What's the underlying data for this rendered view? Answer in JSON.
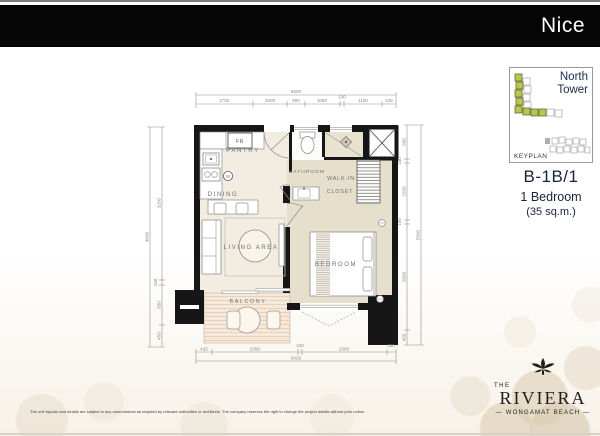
{
  "banner": {
    "title": "Nice"
  },
  "keyplan": {
    "tower": "North Tower",
    "caption": "KEYPLAN"
  },
  "unit": {
    "code": "B-1B/1",
    "type": "1 Bedroom",
    "area": "(35 sq.m.)"
  },
  "rooms": {
    "pantry": "PANTRY",
    "dining": "DINING",
    "living": "LIVING AREA",
    "bathroom": "BATHROOM",
    "walkin_line1": "WALK-IN",
    "walkin_line2": "CLOSET",
    "bedroom": "BEDROOM",
    "balcony": "BALCONY",
    "fridge": "FR",
    "washer": "W"
  },
  "dims": {
    "top_total": "5600",
    "top": [
      "1725",
      "1000",
      "550",
      "1060",
      "100",
      "1150",
      "425"
    ],
    "left_total": "4600",
    "left": [
      "3200",
      "100",
      "850",
      "450"
    ],
    "right_total": "5800",
    "right": [
      "900",
      "100",
      "1500",
      "100",
      "2800",
      "400"
    ],
    "bottom": [
      "425",
      "2350",
      "100",
      "2300",
      "250"
    ],
    "bottom_total": "5425"
  },
  "logo": {
    "prefix": "THE",
    "name": "RIVIERA",
    "tagline": "— WONGAMAT BEACH —"
  },
  "footer": {
    "disclaimer": "The unit layouts and details are subject to any amendments as required by relevant authorities or architects. The company reserves the right to change the project details without prior notice."
  },
  "colors": {
    "accent_green": "#b8c84d",
    "navy": "#1b2a4a",
    "wall": "#161616",
    "floor_cream": "#f2ede0",
    "floor_beige": "#e6dfcc",
    "balcony_floor": "#f6e9da"
  }
}
